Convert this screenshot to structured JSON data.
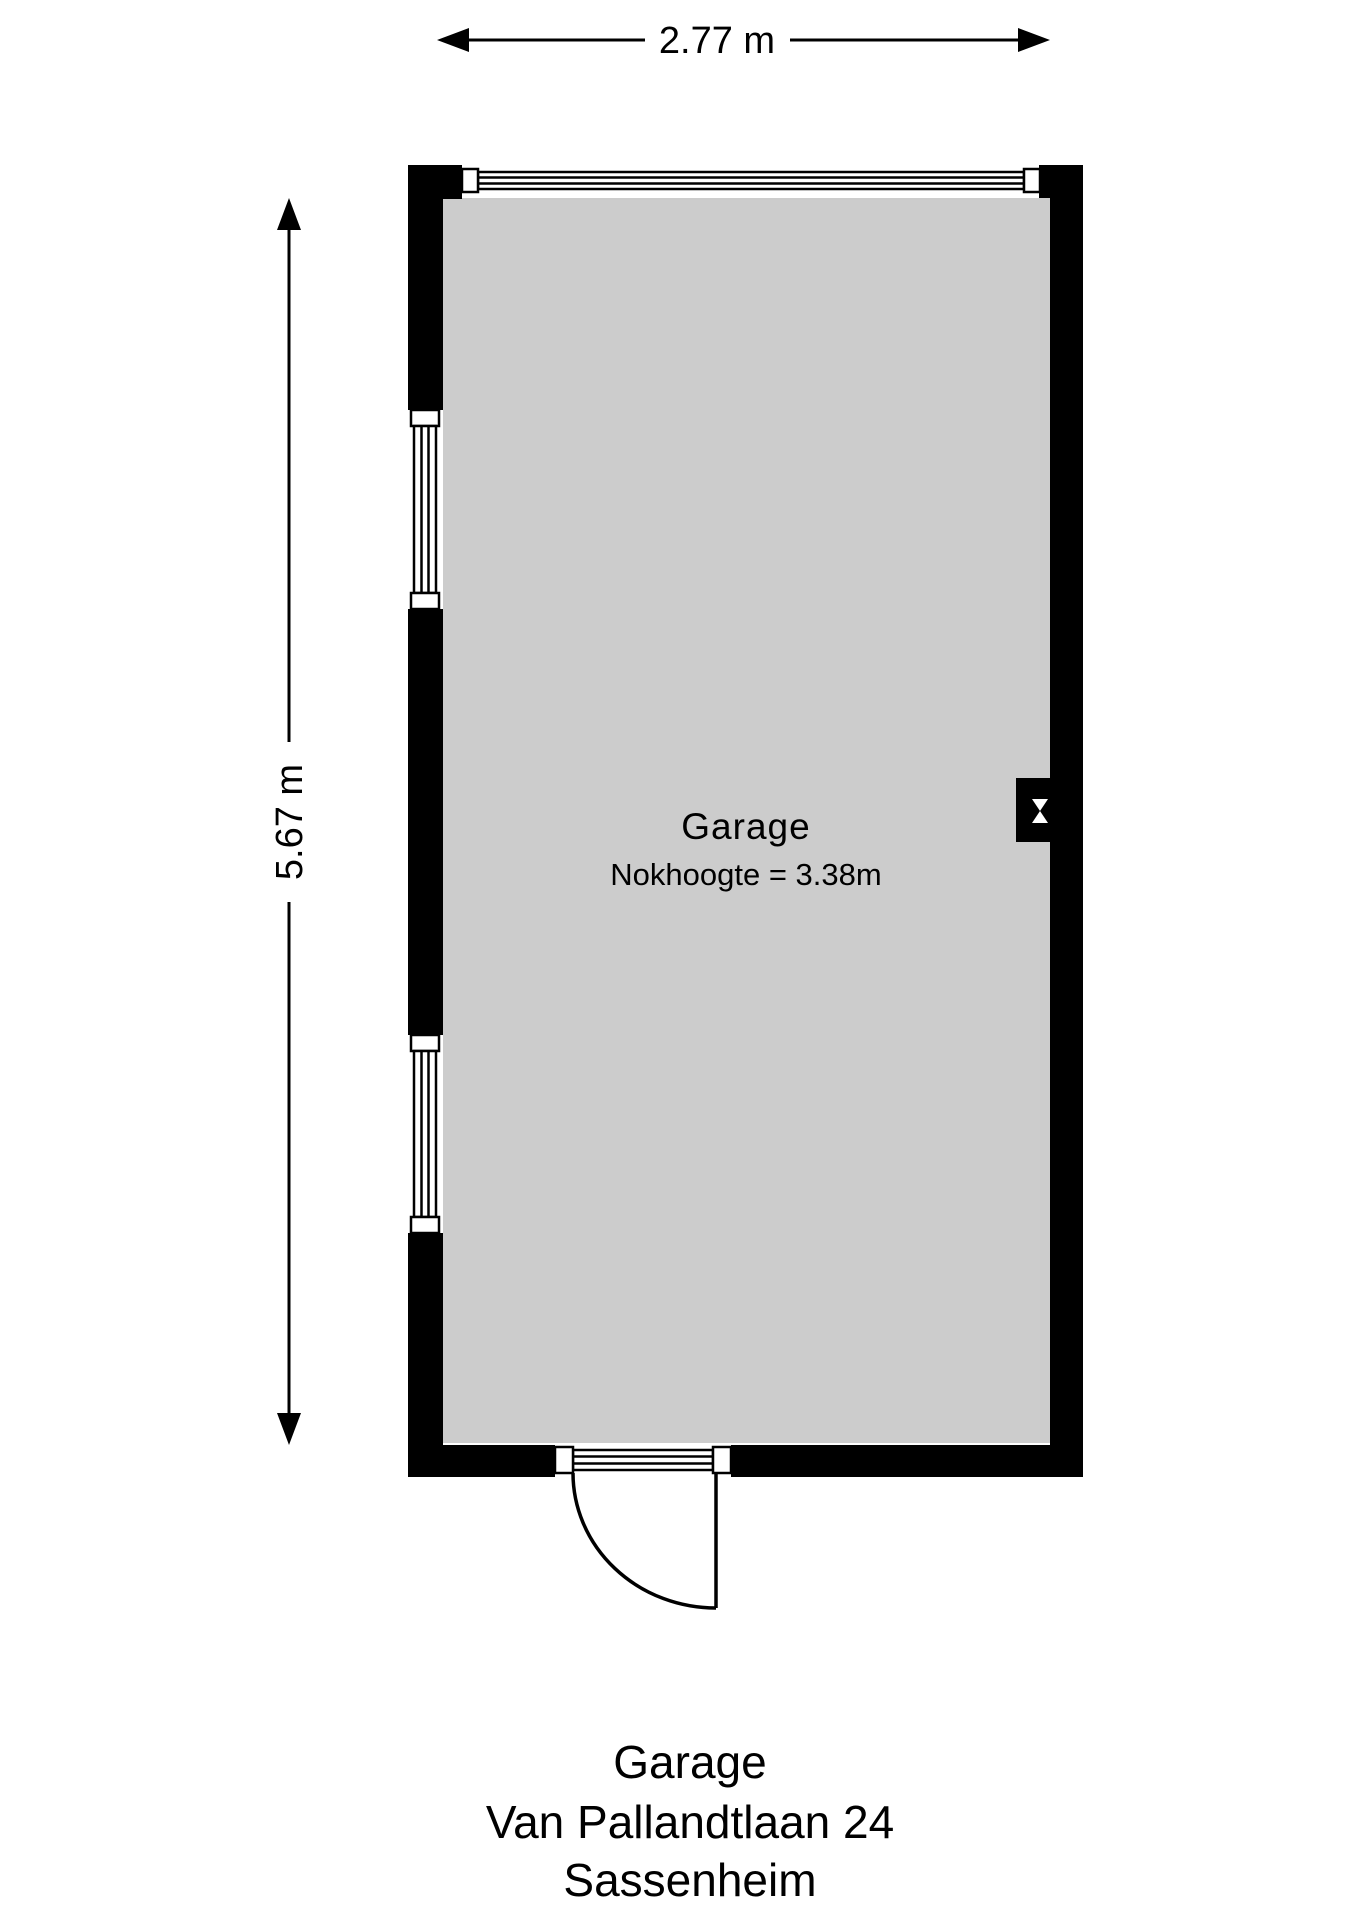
{
  "dimensions": {
    "top": "2.77 m",
    "left": "5.67 m"
  },
  "room": {
    "name": "Garage",
    "detail": "Nokhoogte = 3.38m"
  },
  "caption": {
    "line1": "Garage",
    "line2": "Van Pallandtlaan 24",
    "line3": "Sassenheim"
  },
  "colors": {
    "wall": "#000000",
    "floor": "#cccccc",
    "background": "#ffffff",
    "text": "#000000"
  },
  "icons": {
    "window": "double-line-window-icon",
    "door": "quarter-swing-door-icon",
    "wall_marker": "hourglass-vent-marker-icon",
    "dimension_arrows": "double-headed-arrow-icon"
  }
}
